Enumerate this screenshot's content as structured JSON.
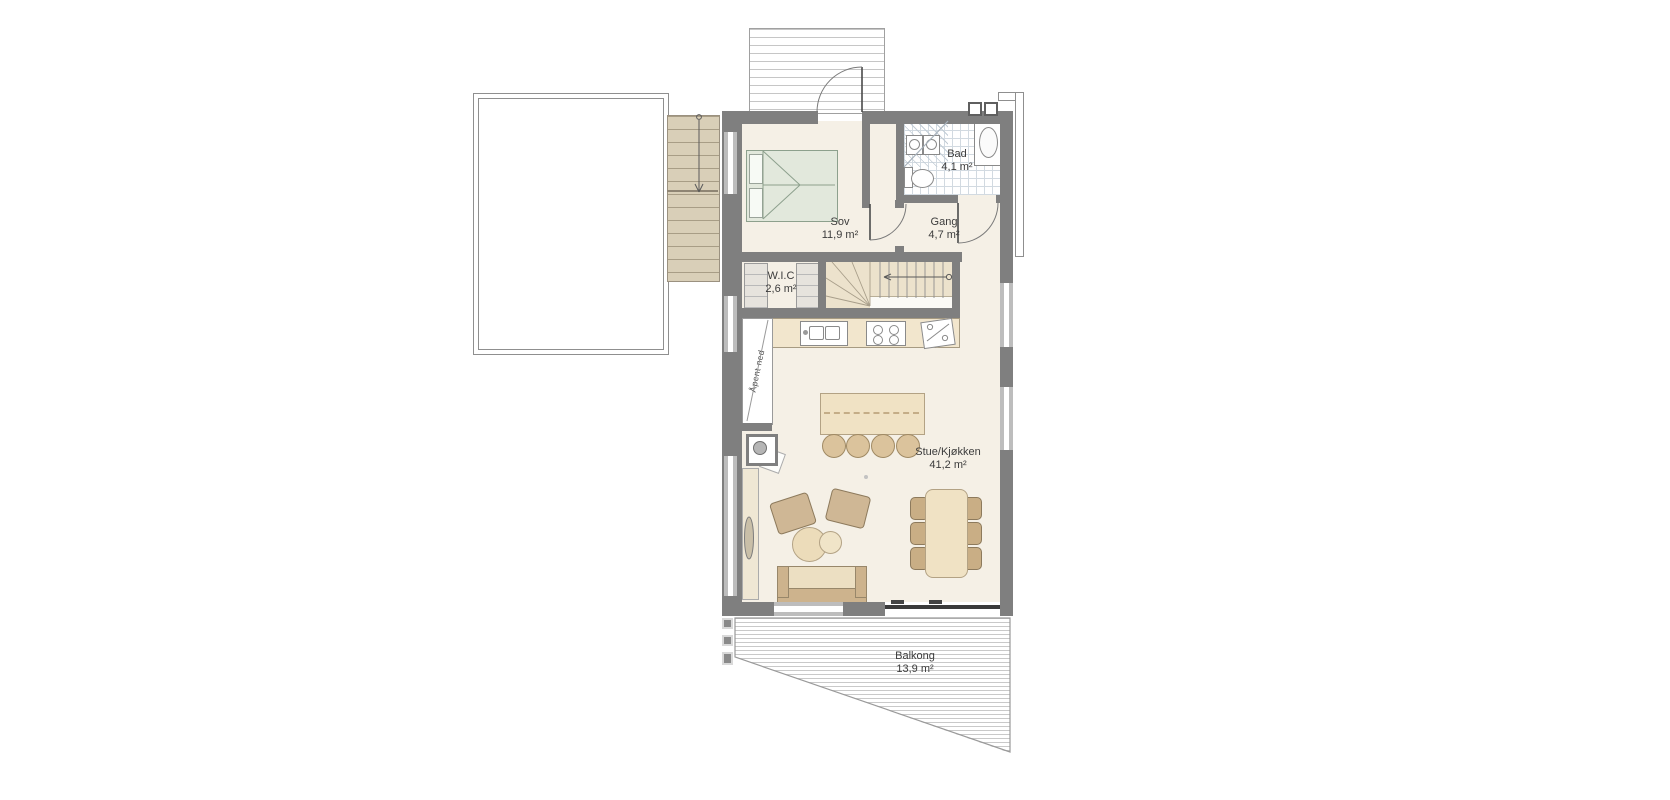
{
  "rooms": [
    {
      "id": "sov",
      "name": "Sov",
      "area": "11,9 m²"
    },
    {
      "id": "bad",
      "name": "Bad",
      "area": "4,1 m²"
    },
    {
      "id": "gang",
      "name": "Gang",
      "area": "4,7 m²"
    },
    {
      "id": "wic",
      "name": "W.I.C",
      "area": "2,6 m²"
    },
    {
      "id": "stue",
      "name": "Stue/Kjøkken",
      "area": "41,2 m²"
    },
    {
      "id": "balkong",
      "name": "Balkong",
      "area": "13,9 m²"
    }
  ],
  "annotations": {
    "open_below": "Åpent ned"
  },
  "colors": {
    "floor": "#f5f0e6",
    "wall": "#7f7f7f",
    "wood_light": "#f0e2c4",
    "wood_dark": "#c9ae85",
    "stair_wood": "#d9cfb8",
    "tile_line": "#d2dae1",
    "bed": "#e2e8dc",
    "text": "#3c3c3c",
    "deck_line": "#c6c6c6"
  }
}
